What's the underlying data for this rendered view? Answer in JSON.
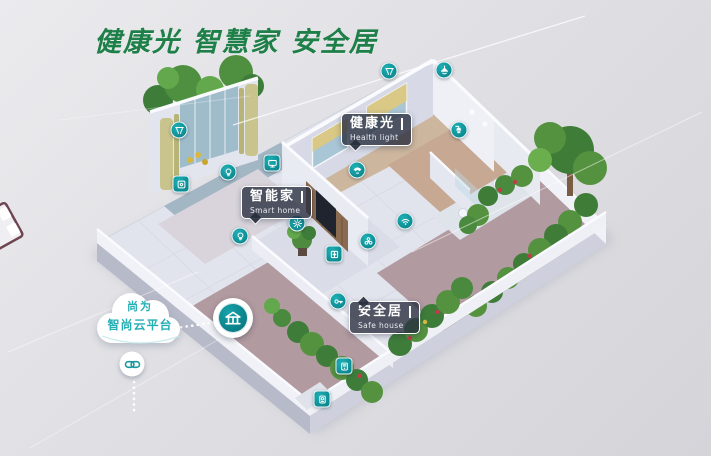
{
  "title": {
    "text": "健康光 智慧家 安全居",
    "color": "#1e7f48"
  },
  "cloud_platform": {
    "line1": "尚为",
    "line2": "智尚云平台",
    "text_color": "#24afb5"
  },
  "callouts": {
    "health_light": {
      "zh": "健康光",
      "en": "Health light"
    },
    "smart_home": {
      "zh": "智能家",
      "en": "Smart home"
    },
    "safe_house": {
      "zh": "安全居",
      "en": "Safe house"
    }
  },
  "colors": {
    "accent_teal": "#10989e",
    "hub_teal": "#0d8a91",
    "callout_bg": "rgba(38,44,60,0.78)",
    "title_green": "#1e7f48",
    "background": "#dedee2"
  },
  "device_icons": [
    {
      "name": "curtain-icon",
      "glyph": "curtain",
      "shape": "circle",
      "x": 389,
      "y": 71
    },
    {
      "name": "ceiling-light-icon",
      "glyph": "ceiling-light",
      "shape": "circle",
      "x": 444,
      "y": 70
    },
    {
      "name": "curtain-icon",
      "glyph": "curtain",
      "shape": "circle",
      "x": 179,
      "y": 130
    },
    {
      "name": "light-bulb-icon",
      "glyph": "bulb",
      "shape": "circle",
      "x": 228,
      "y": 172
    },
    {
      "name": "tv-icon",
      "glyph": "tv",
      "shape": "square",
      "x": 272,
      "y": 163
    },
    {
      "name": "wall-switch-icon",
      "glyph": "switch",
      "shape": "square",
      "x": 181,
      "y": 184
    },
    {
      "name": "light-bulb-icon",
      "glyph": "bulb",
      "shape": "circle",
      "x": 240,
      "y": 236
    },
    {
      "name": "gear-icon",
      "glyph": "gear",
      "shape": "circle",
      "x": 297,
      "y": 223
    },
    {
      "name": "phone-icon",
      "glyph": "phone",
      "shape": "circle",
      "x": 357,
      "y": 170
    },
    {
      "name": "shower-icon",
      "glyph": "shower",
      "shape": "circle",
      "x": 459,
      "y": 130
    },
    {
      "name": "wifi-icon",
      "glyph": "wifi",
      "shape": "circle",
      "x": 405,
      "y": 221
    },
    {
      "name": "fan-icon",
      "glyph": "fan",
      "shape": "circle",
      "x": 368,
      "y": 241
    },
    {
      "name": "double-door-icon",
      "glyph": "door",
      "shape": "square",
      "x": 334,
      "y": 254
    },
    {
      "name": "key-icon",
      "glyph": "key",
      "shape": "circle",
      "x": 338,
      "y": 301
    },
    {
      "name": "intercom-icon",
      "glyph": "intercom",
      "shape": "square",
      "x": 344,
      "y": 366
    },
    {
      "name": "doorbell-icon",
      "glyph": "doorbell",
      "shape": "square",
      "x": 322,
      "y": 399
    }
  ],
  "hub_icon": {
    "name": "gateway-hub-icon",
    "x": 233,
    "y": 318
  },
  "link_icon": {
    "name": "cloud-link-icon",
    "x": 132,
    "y": 364
  }
}
